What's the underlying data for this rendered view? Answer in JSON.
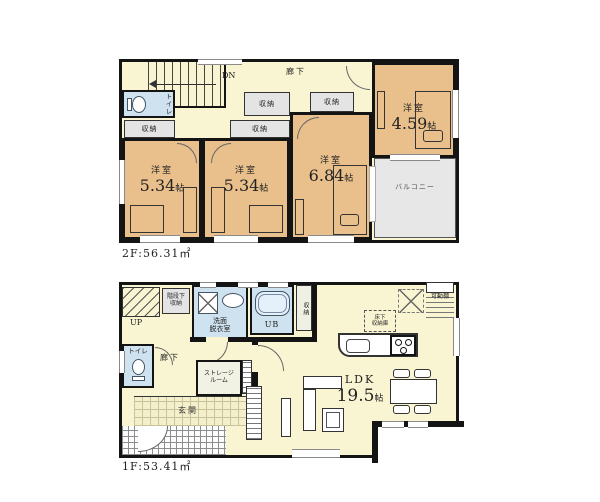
{
  "colors": {
    "wall": "#141414",
    "western_room": "#e9c08c",
    "hallway": "#f9f5d3",
    "wet_area": "#cfe2f0",
    "closet": "#e4e4e4",
    "balcony": "#e7e7e7",
    "entrance_tile": "#f4f0cc"
  },
  "floor2": {
    "area": "2F:56.31㎡",
    "labels": {
      "dn": "DN",
      "hallway": "廊下",
      "toilet": "トイレ",
      "closet": "収納",
      "balcony": "バルコニー"
    },
    "rooms": [
      {
        "type": "洋室",
        "num": "5.34",
        "unit": "帖"
      },
      {
        "type": "洋室",
        "num": "5.34",
        "unit": "帖"
      },
      {
        "type": "洋室",
        "num": "6.84",
        "unit": "帖"
      },
      {
        "type": "洋室",
        "num": "4.59",
        "unit": "帖"
      }
    ]
  },
  "floor1": {
    "area": "1F:53.41㎡",
    "labels": {
      "up": "UP",
      "under_stair_storage": "階段下\n収納",
      "washroom": "洗面\n脱衣室",
      "bath": "UB",
      "closet": "収納",
      "toilet": "トイレ",
      "hallway": "廊下",
      "storage_room": "ストレージ\nルーム",
      "movable_shelf": "可動棚",
      "entrance": "玄関",
      "underfloor_storage": "床下\n収納庫"
    },
    "ldk": {
      "type": "LDK",
      "num": "19.5",
      "unit": "帖"
    }
  }
}
